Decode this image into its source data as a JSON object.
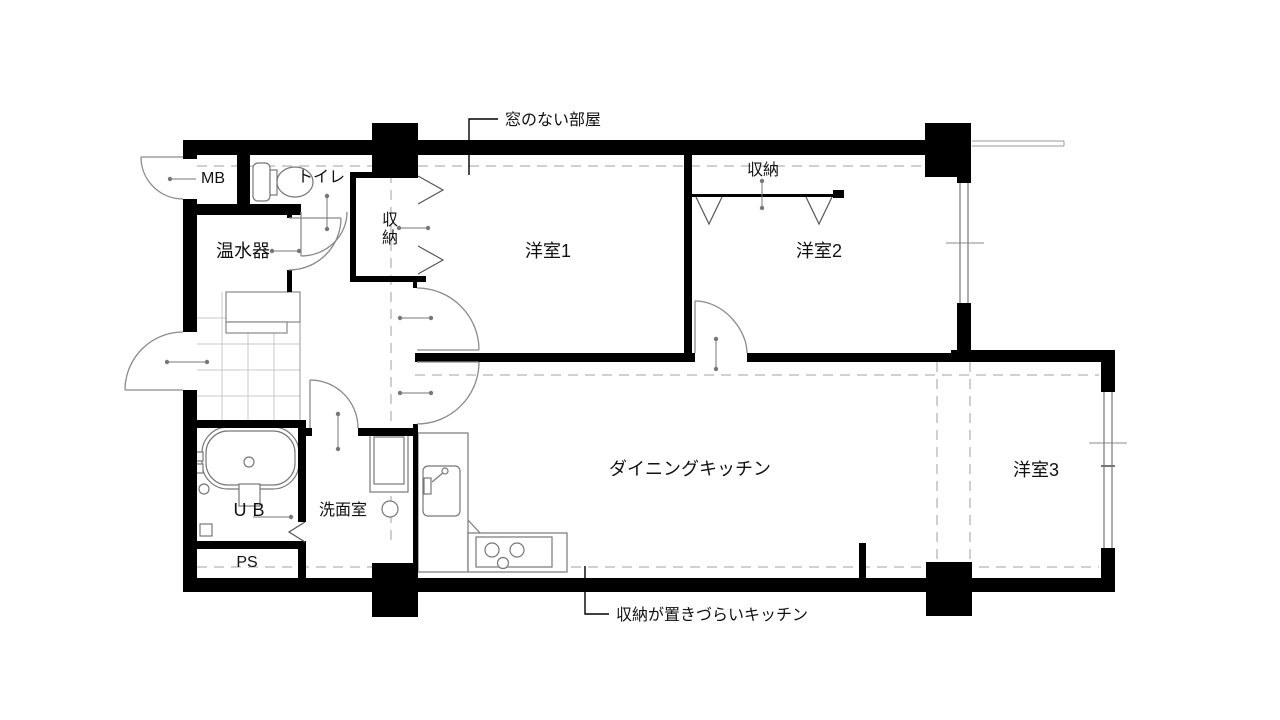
{
  "labels": {
    "mb": "MB",
    "toilet": "トイレ",
    "hall_closet": "収納",
    "water_heater": "温水器",
    "room1": "洋室1",
    "room2_closet": "収納",
    "room2": "洋室2",
    "dining_kitchen": "ダイニングキッチン",
    "room3": "洋室3",
    "unit_bath": "UB",
    "washroom": "洗面室",
    "pipe_space": "PS"
  },
  "annotations": {
    "no_window_room": "窓のない部屋",
    "kitchen_storage_note": "収納が置きづらいキッチン"
  },
  "colors": {
    "wall": "#000000",
    "thin_line": "#888888",
    "dashed_beam": "#b5b5b5",
    "background": "#ffffff"
  }
}
